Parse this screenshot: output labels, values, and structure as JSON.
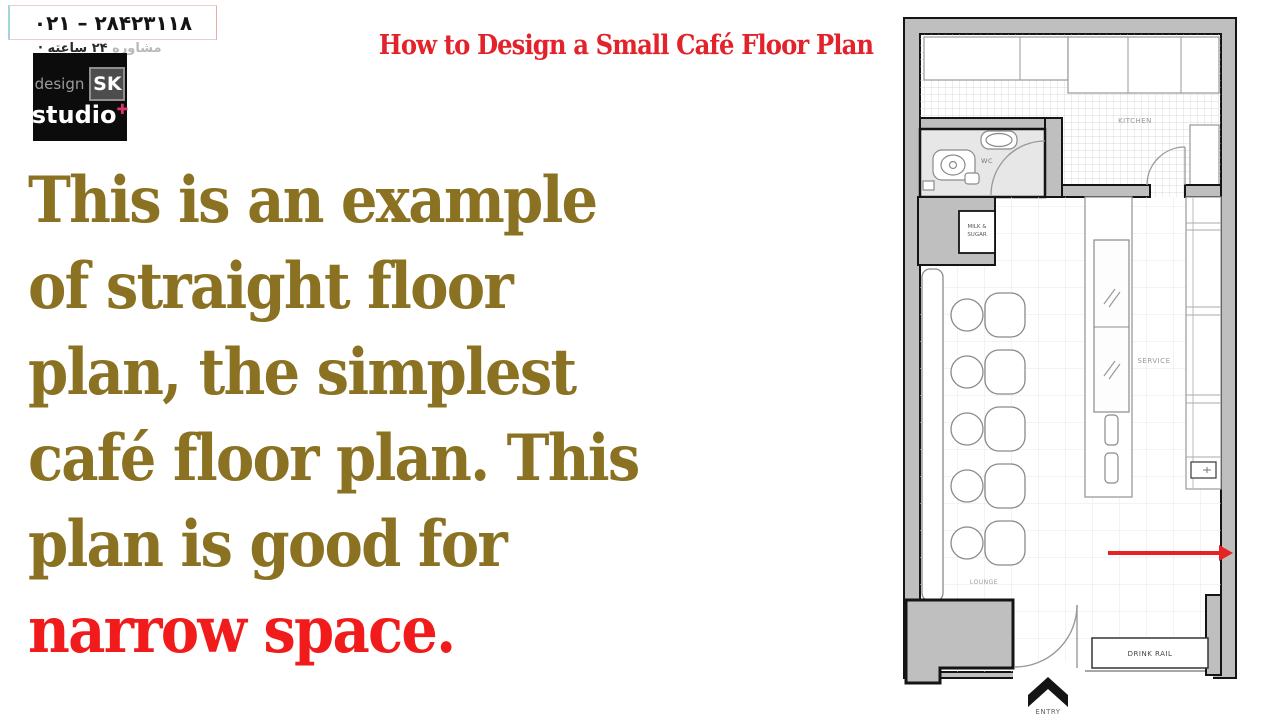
{
  "slide": {
    "phone_number": "۰۲۱ – ۲۸۴۲۳۱۱۸",
    "subtitle_fa_light": "مشاوره",
    "subtitle_fa_dark": " ۲۴ ساعته ·",
    "title": "How to Design a Small Café Floor Plan"
  },
  "logo": {
    "design": "design",
    "sk": "SK",
    "studio": "studio",
    "plus": "✚"
  },
  "paragraph": {
    "lines": [
      {
        "text": "This is an example",
        "color": "#8a7222"
      },
      {
        "text": "of straight floor",
        "color": "#8a7222"
      },
      {
        "text": "plan, the simplest",
        "color": "#8a7222"
      },
      {
        "text": "café floor plan. This",
        "color": "#8a7222"
      },
      {
        "text": "plan is good for",
        "color": "#8a7222"
      },
      {
        "text": "narrow space.",
        "color": "#f11b1b"
      }
    ]
  },
  "floor_plan": {
    "labels": {
      "kitchen": "KITCHEN",
      "wc": "WC",
      "milk_sugar_line1": "MILK &",
      "milk_sugar_line2": "SUGAR",
      "service": "SERVICE",
      "lounge": "LOUNGE",
      "drink_rail": "DRINK RAIL",
      "entry": "ENTRY"
    }
  },
  "colors": {
    "title_red": "#e3232b",
    "body_olive": "#8a7222",
    "highlight_red": "#f11b1b",
    "logo_pink": "#d6336c",
    "wall_gray": "#bfbfbf",
    "arrow_red": "#e62222"
  }
}
